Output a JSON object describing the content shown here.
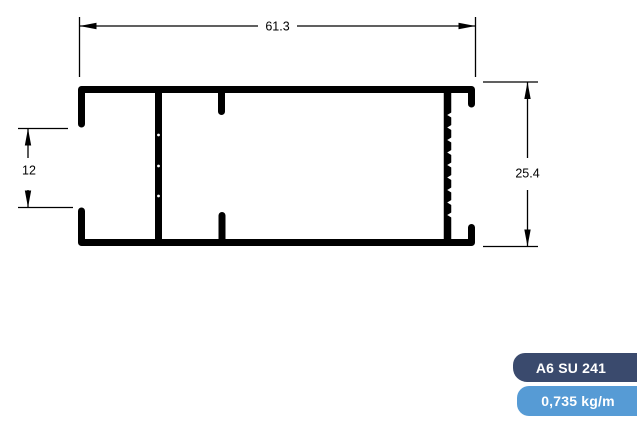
{
  "colors": {
    "line": "#000000",
    "background": "#ffffff",
    "badge_code_bg": "#3a4a6d",
    "badge_weight_bg": "#569bd5",
    "badge_text": "#ffffff"
  },
  "drawing": {
    "title": "aluminium profile cross-section",
    "width_dim": "61.3",
    "height_dim": "25.4",
    "opening_dim": "12"
  },
  "labels": {
    "profile_code": "A6 SU 241",
    "weight": "0,735 kg/m"
  }
}
